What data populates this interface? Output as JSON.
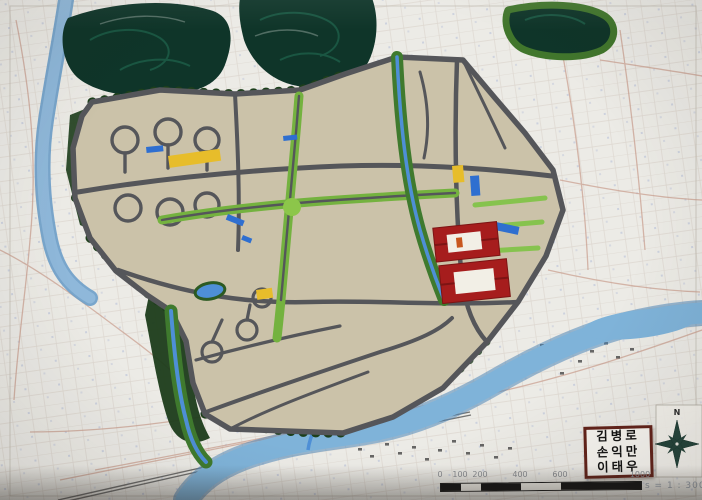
{
  "map": {
    "kind": "urban-master-plan-photo",
    "name_plate": {
      "names": [
        "김병로",
        "손익만",
        "이태우"
      ]
    },
    "compass": {
      "label": "N"
    },
    "scale_bar": {
      "ticks": [
        "0",
        "100",
        "200",
        "400",
        "600",
        "1000"
      ],
      "text": "s = 1 : 3000"
    },
    "palette": {
      "base_map": "#ecebe6",
      "cadastral_line": "#c99d8d",
      "forest": "#0f3529",
      "forest_swirl": "#1d5f49",
      "forest_fringe": "#41762c",
      "river": "#8fb8da",
      "river_deep": "#5f93c0",
      "site_base": "#cbc2a9",
      "road": "#55565a",
      "tree_belt": "#1d3f1b",
      "boulevard_green": "#74b23f",
      "park_green": "#8cc64a",
      "housing_yellow": "#e4cf55",
      "housing_white": "#f4f1e8",
      "open_brown": "#a8853e",
      "accent_yellow": "#e7bd2b",
      "accent_blue": "#2f6fd0",
      "stream_blue": "#4e8fd6",
      "commercial_red": "#a61d1d",
      "plate_border": "#62231a",
      "scale_ink": "#151515",
      "muted_ink": "#8b8e93"
    }
  }
}
